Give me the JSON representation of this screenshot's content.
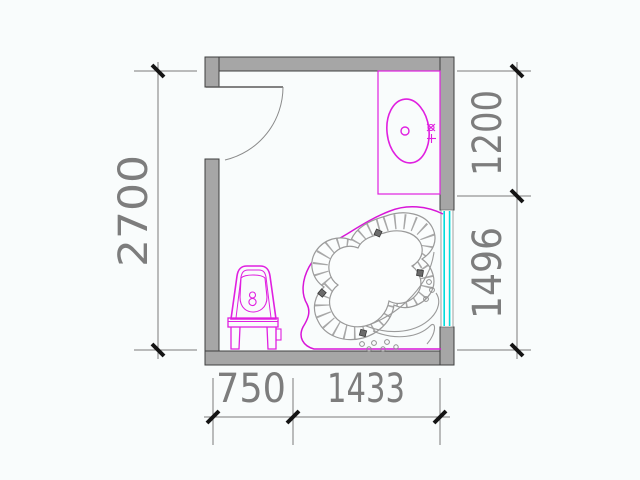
{
  "drawing": {
    "type": "bathroom-floor-plan",
    "dimensions": {
      "left_height": "2700",
      "right_top": "1200",
      "right_bottom": "1496",
      "bottom_left": "750",
      "bottom_right": "1433"
    },
    "fixtures": {
      "door": "hinged-door",
      "basin": "vanity-counter-with-oval-basin",
      "tub": "freeform-spa-bathtub",
      "toilet": "toilet",
      "window": "glazed-window"
    },
    "colors": {
      "background": "#f9fcfc",
      "wall_fill": "#a6a6a6",
      "wall_edge": "#3f3f3f",
      "fixture_magenta": "#e020e0",
      "tub_outline_magenta": "#d816d8",
      "window_cyan": "#00dcdc",
      "dim_line_gray": "#7a7a7a",
      "dim_text_gray": "#7d7d7d",
      "tick_black": "#141414",
      "tub_rim_gray": "#9a9a9a"
    }
  }
}
